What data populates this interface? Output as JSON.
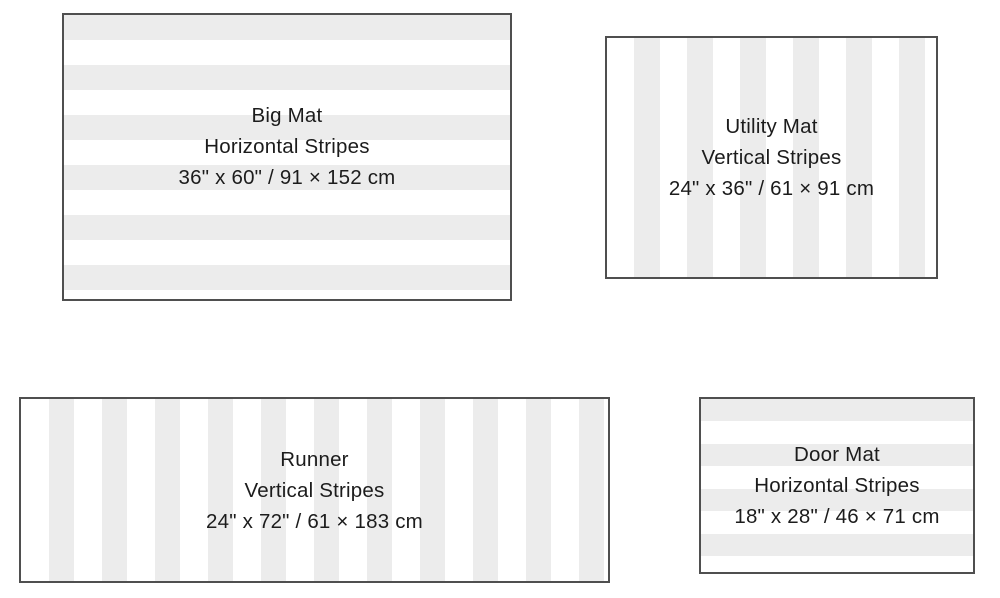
{
  "colors": {
    "background": "#ffffff",
    "stripe_gray": "#ececec",
    "stripe_white": "#ffffff",
    "mat_border": "#4f4f4f",
    "text": "#1c1c1c"
  },
  "mats": [
    {
      "name": "Big Mat",
      "pattern": "Horizontal Stripes",
      "dimensions": "36\" x 60\" / 91 × 152 cm",
      "stripe_direction": "horizontal"
    },
    {
      "name": "Utility Mat",
      "pattern": "Vertical Stripes",
      "dimensions": "24\" x 36\" / 61 × 91 cm",
      "stripe_direction": "vertical"
    },
    {
      "name": "Runner",
      "pattern": "Vertical Stripes",
      "dimensions": "24\" x 72\" / 61 × 183 cm",
      "stripe_direction": "vertical"
    },
    {
      "name": "Door Mat",
      "pattern": "Horizontal Stripes",
      "dimensions": "18\" x 28\" / 46 × 71 cm",
      "stripe_direction": "horizontal"
    }
  ]
}
